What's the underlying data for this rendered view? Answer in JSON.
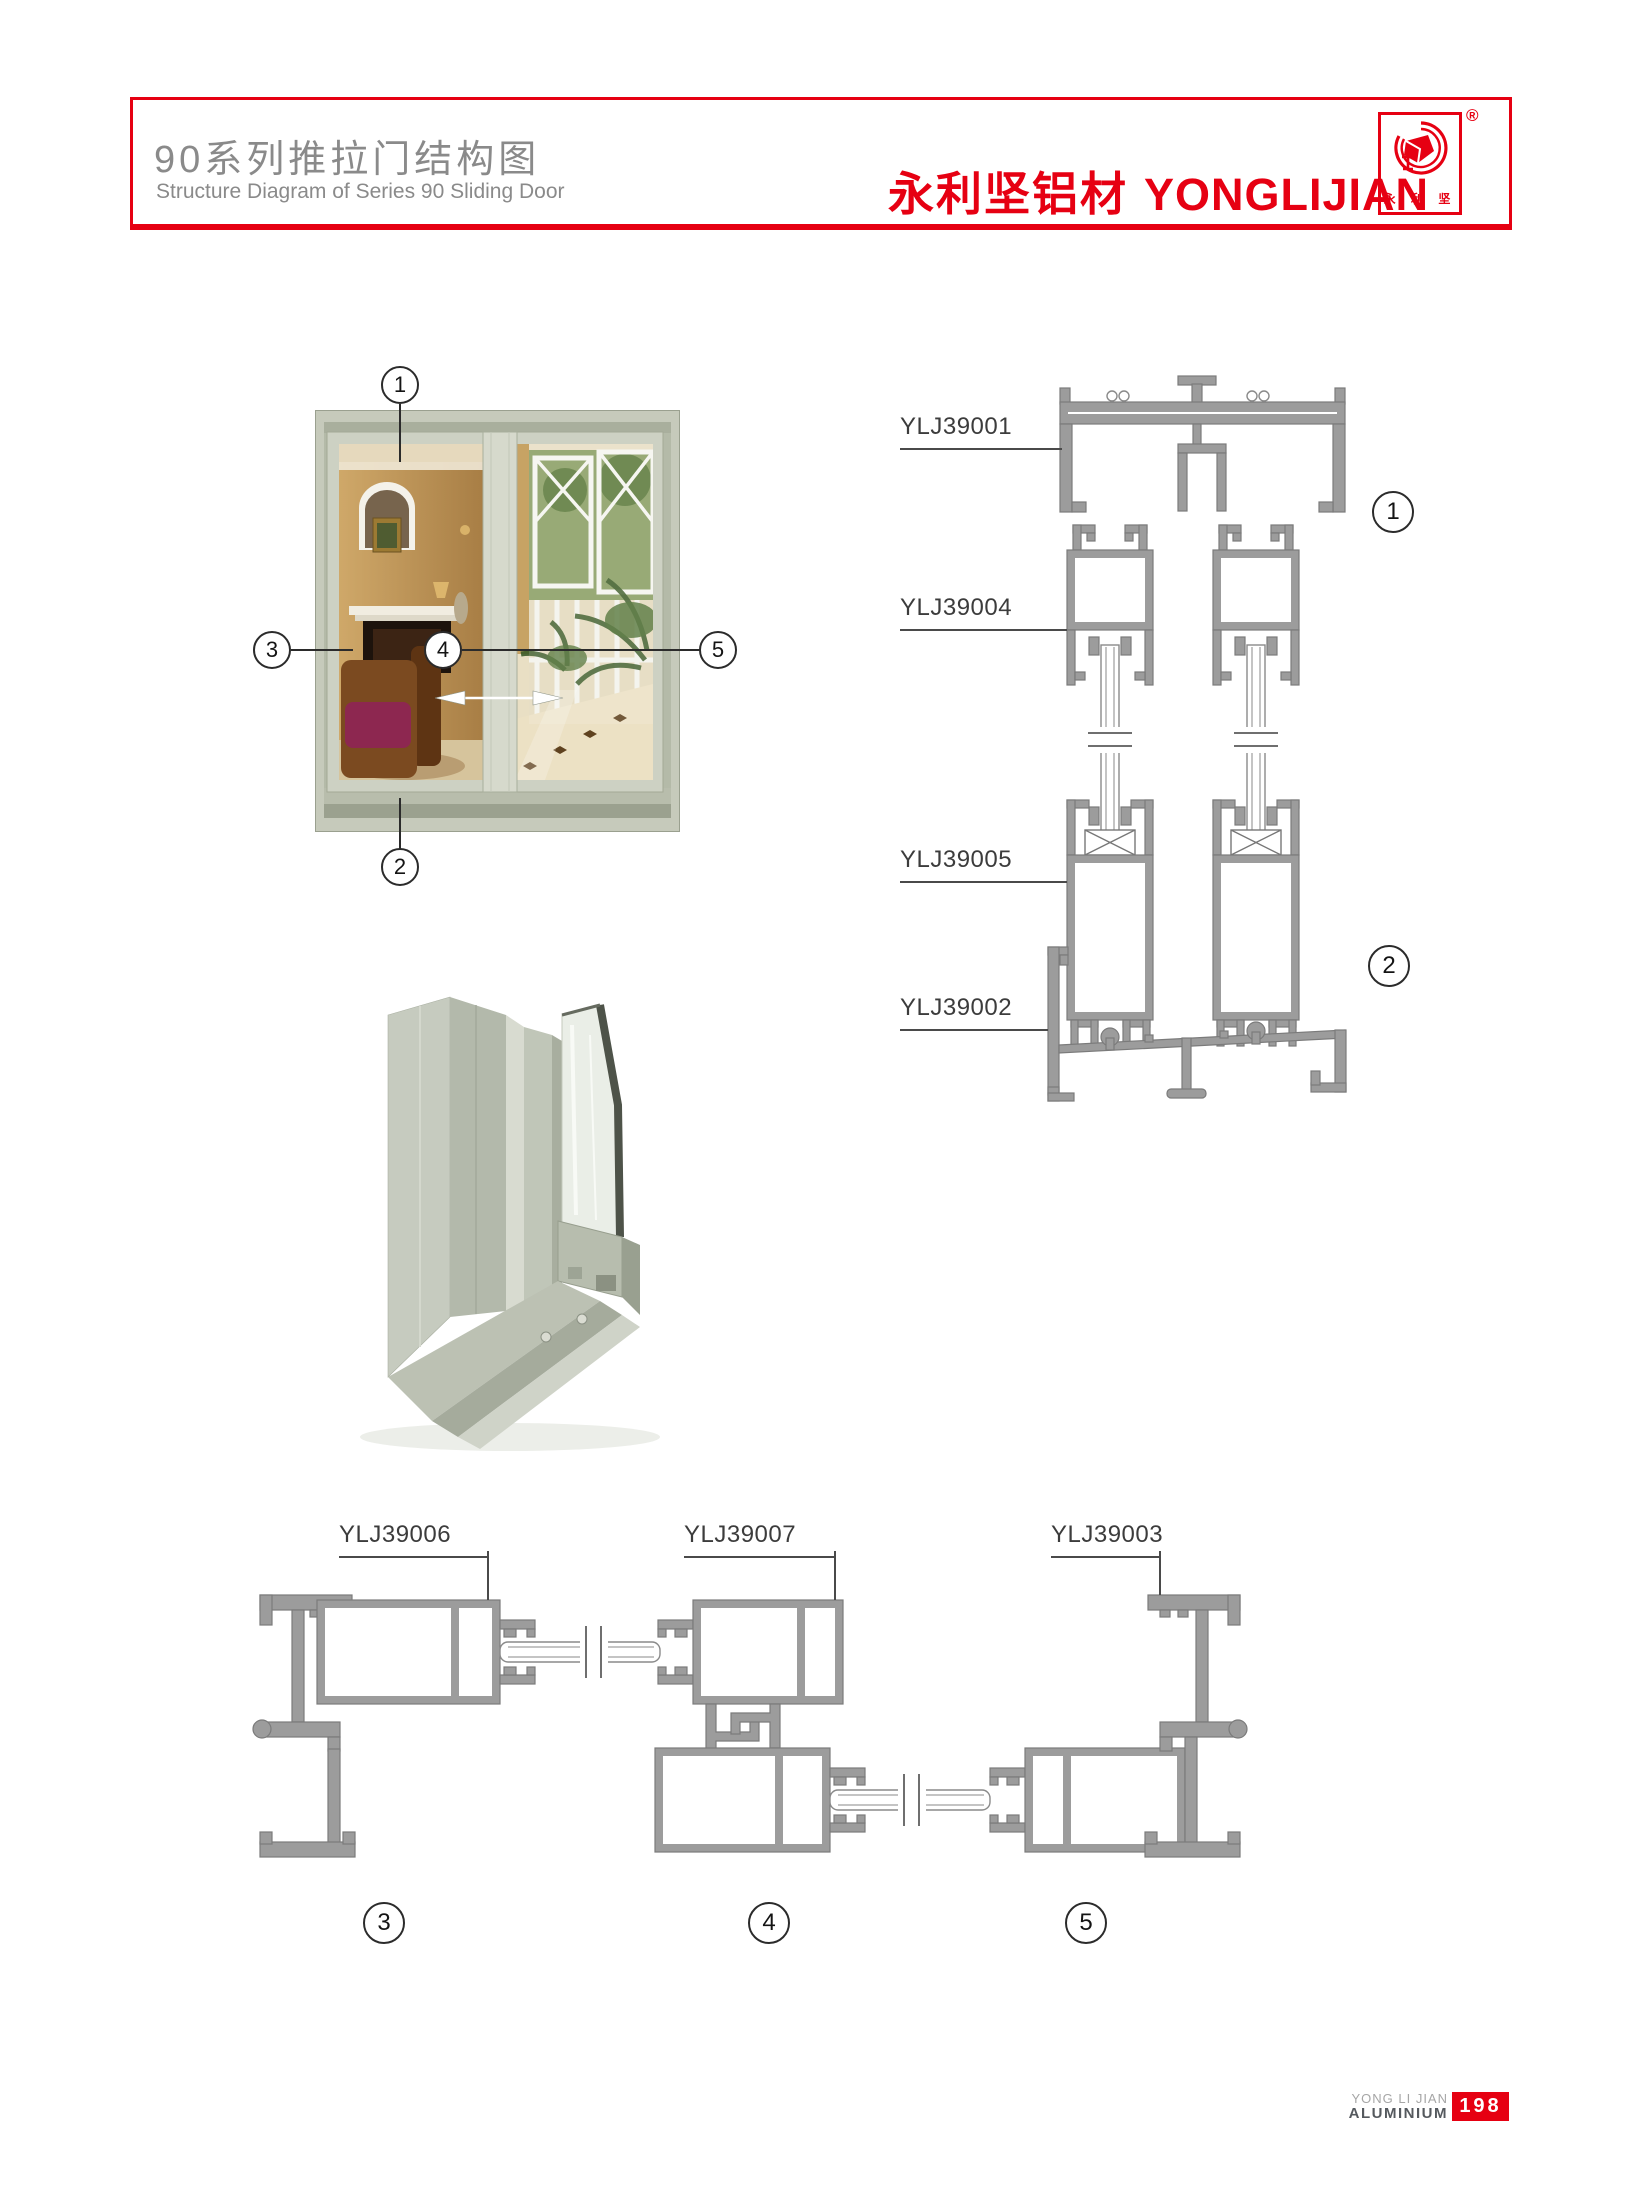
{
  "header": {
    "title_cn": "90系列推拉门结构图",
    "title_en": "Structure Diagram of Series 90 Sliding Door",
    "brand_cn": "永利坚铝材",
    "brand_en": "YONGLIJIAN",
    "registered_mark": "®",
    "logo_caption": "永 利 坚"
  },
  "door_figure": {
    "callouts": {
      "c1": "1",
      "c2": "2",
      "c3": "3",
      "c4": "4",
      "c5": "5"
    }
  },
  "vertical_section": {
    "labels": [
      "YLJ39001",
      "YLJ39004",
      "YLJ39005",
      "YLJ39002"
    ],
    "callouts": [
      "1",
      "2"
    ]
  },
  "horizontal_section": {
    "labels": [
      "YLJ39006",
      "YLJ39007",
      "YLJ39003"
    ],
    "callouts": [
      "3",
      "4",
      "5"
    ]
  },
  "footer": {
    "company_line1": "YONG LI JIAN",
    "company_line2": "ALUMINIUM",
    "page_number": "198"
  },
  "colors": {
    "accent_red": "#e60012",
    "profile_fill": "#9c9c9c",
    "profile_stroke": "#7b7b7b",
    "title_gray": "#8a8a8a",
    "label_gray": "#3c3c3c",
    "door_frame_sage": "#c6cabb"
  }
}
